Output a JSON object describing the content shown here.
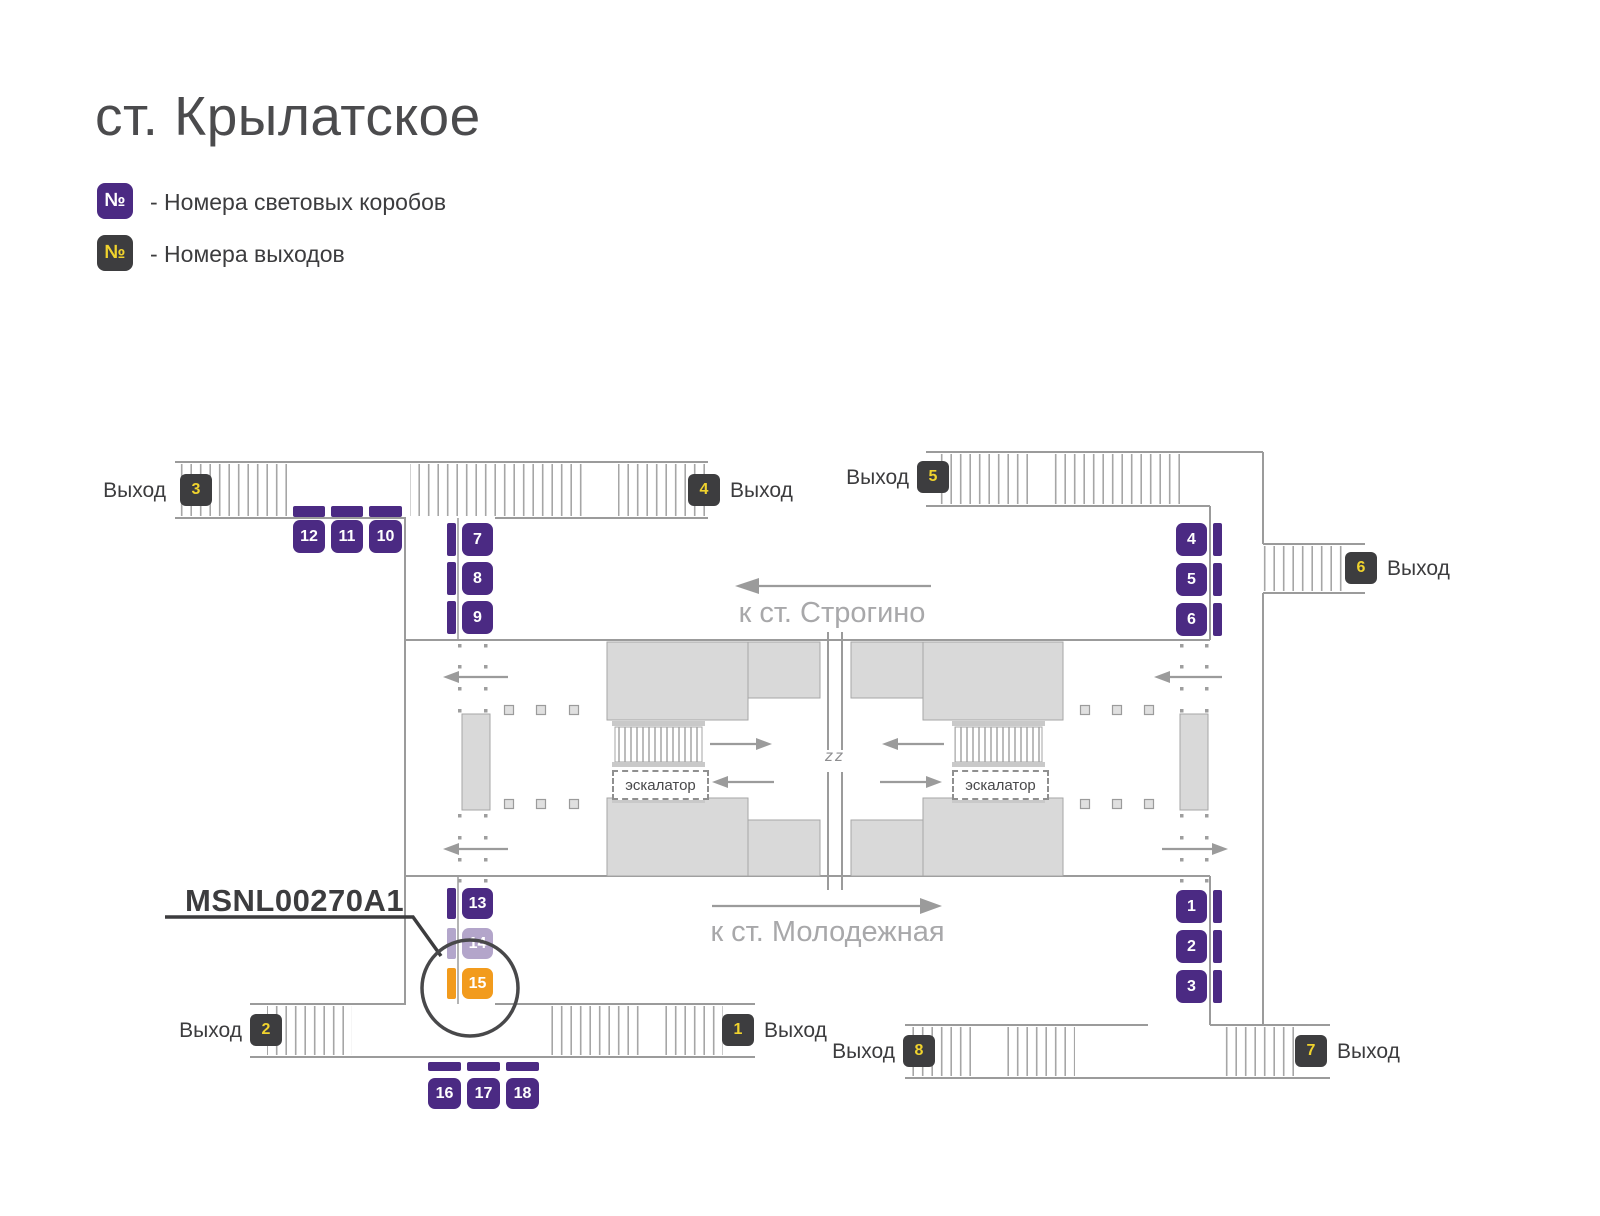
{
  "title": "ст. Крылатское",
  "legend": {
    "items": [
      {
        "symbol": "№",
        "label": "- Номера световых коробов",
        "meaning": "light-box-numbers"
      },
      {
        "symbol": "№",
        "label": "- Номера выходов",
        "meaning": "exit-numbers"
      }
    ]
  },
  "map": {
    "callout": {
      "code": "MSNL00270A1",
      "target_box": "15"
    },
    "directions": {
      "strogino": "к ст. Строгино",
      "molodezhnaya": "к ст. Молодежная"
    },
    "escalators": [
      {
        "label": "эскалатор"
      },
      {
        "label": "эскалатор"
      }
    ],
    "center_mark": "zz",
    "exits": [
      {
        "n": "3",
        "label": "Выход"
      },
      {
        "n": "4",
        "label": "Выход"
      },
      {
        "n": "5",
        "label": "Выход"
      },
      {
        "n": "6",
        "label": "Выход"
      },
      {
        "n": "2",
        "label": "Выход"
      },
      {
        "n": "1",
        "label": "Выход"
      },
      {
        "n": "8",
        "label": "Выход"
      },
      {
        "n": "7",
        "label": "Выход"
      }
    ],
    "light_boxes": [
      {
        "n": "12",
        "state": "normal"
      },
      {
        "n": "11",
        "state": "normal"
      },
      {
        "n": "10",
        "state": "normal"
      },
      {
        "n": "7",
        "state": "normal"
      },
      {
        "n": "8",
        "state": "normal"
      },
      {
        "n": "9",
        "state": "normal"
      },
      {
        "n": "4",
        "state": "normal"
      },
      {
        "n": "5",
        "state": "normal"
      },
      {
        "n": "6",
        "state": "normal"
      },
      {
        "n": "13",
        "state": "normal"
      },
      {
        "n": "14",
        "state": "dimmed"
      },
      {
        "n": "15",
        "state": "highlighted"
      },
      {
        "n": "1",
        "state": "normal"
      },
      {
        "n": "2",
        "state": "normal"
      },
      {
        "n": "3",
        "state": "normal"
      },
      {
        "n": "16",
        "state": "normal"
      },
      {
        "n": "17",
        "state": "normal"
      },
      {
        "n": "18",
        "state": "normal"
      }
    ]
  },
  "colors": {
    "box_purple": "#4b2a83",
    "exit_dark": "#3d3d3f",
    "number_yellow": "#f0d32d",
    "highlight_orange": "#f29b1d",
    "wall_gray": "#9b9b9b",
    "fill_gray": "#d9d9d9",
    "text_dark": "#3c3c3e",
    "text_light": "#a8a8aa"
  }
}
